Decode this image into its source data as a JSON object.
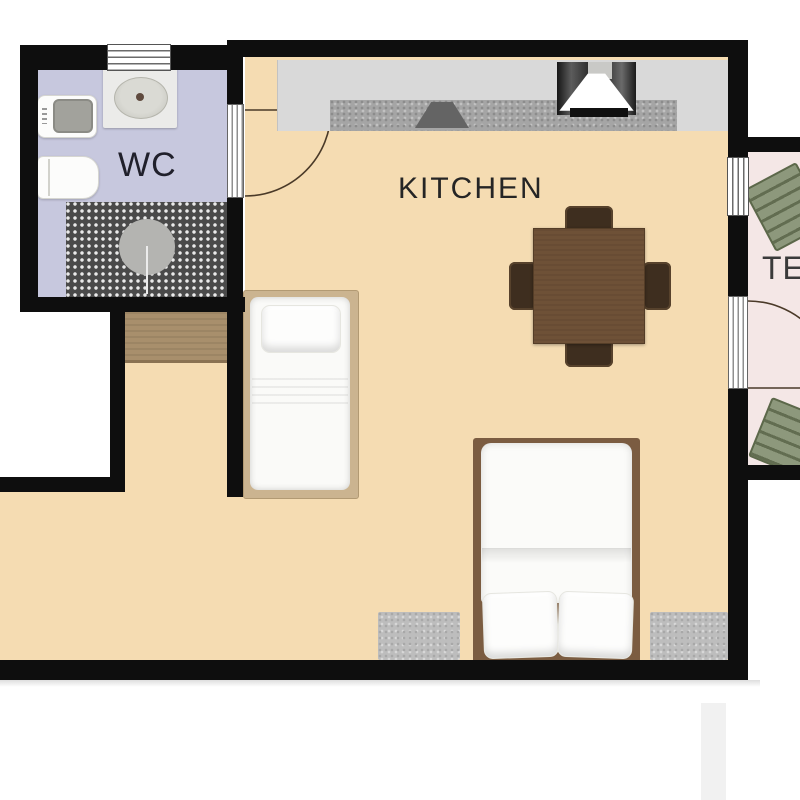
{
  "labels": {
    "wc": "WC",
    "kitchen": "KITCHEN",
    "terrace": "TE"
  },
  "palette": {
    "wall": "#0e0e0e",
    "floor-wc": "#c7c8de",
    "floor-main": "#f5dcb2",
    "floor-terrace": "#f4e7e6",
    "counter": "#d9d9d9",
    "worktop": "#a5a5a5",
    "wood-table": "#6e5137",
    "chair-dark": "#3e2e1f",
    "chair-green": "#8d987c",
    "bed-frame-light": "#cbb490",
    "bed-frame-dark": "#7b5c41",
    "cabinet-wood": "#a88f6c",
    "rug": "#bdbdbd"
  },
  "furniture": {
    "wc": [
      "sink-vanity",
      "washing-machine",
      "toilet",
      "shower-tiled-area"
    ],
    "kitchen": [
      "kitchen-counter",
      "granite-worktop",
      "hob-sink",
      "extractor-hood",
      "stove",
      "dining-table",
      "dining-chair-x4",
      "single-bed",
      "double-bed",
      "wooden-cabinet",
      "bedside-rug-x2"
    ],
    "terrace": [
      "garden-chair-top",
      "garden-chair-bottom"
    ]
  }
}
